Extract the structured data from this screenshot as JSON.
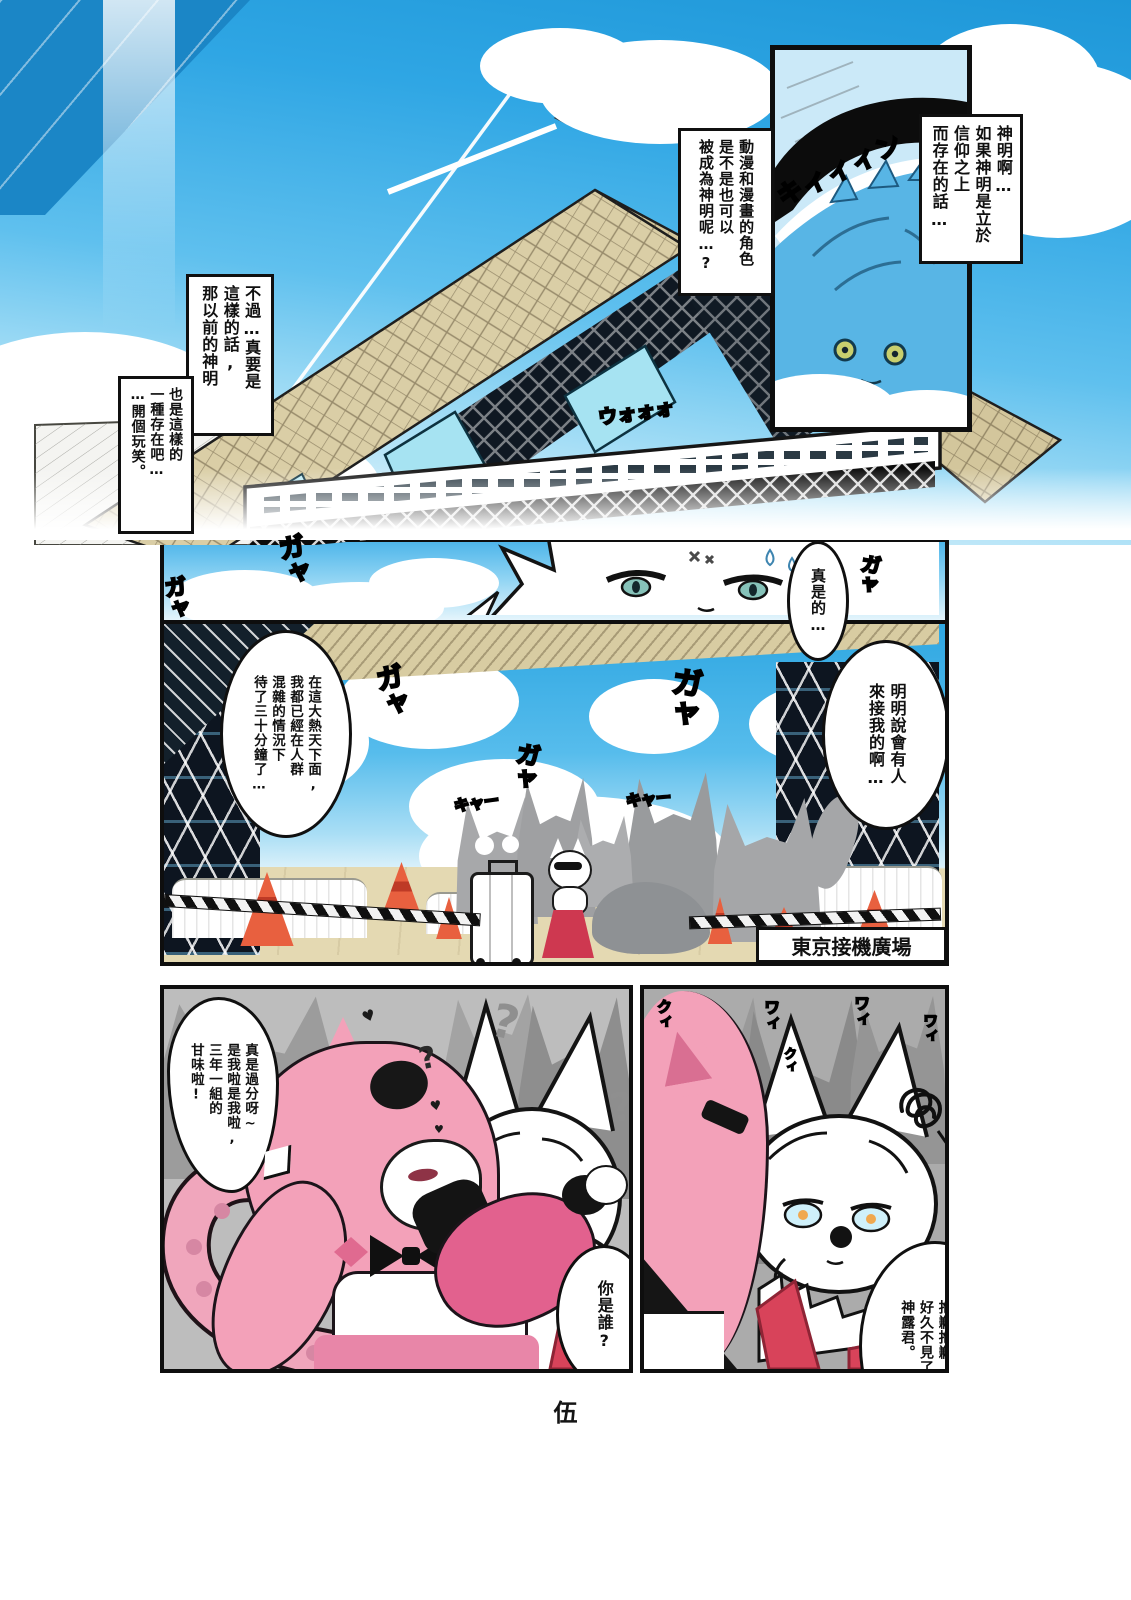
{
  "page_number": "伍",
  "speech": {
    "god_intro": [
      "神明啊…",
      "如果神明是立於",
      "信仰之上",
      "而存在的話…"
    ],
    "anime_chars": [
      "動漫和漫畫的角色",
      "是不是也可以",
      "被成為神明呢…?"
    ],
    "however": [
      "不過…真要是",
      "這樣的話,",
      "那以前的神明"
    ],
    "joking": [
      "也是這樣的",
      "一種存在吧…",
      "…開個玩笑。"
    ],
    "geez": [
      "真是的…"
    ],
    "pickup": [
      "明明說會有人",
      "來接我的啊…"
    ],
    "waiting": [
      "在這大熱天下面,",
      "我都已經在人群",
      "混雜的情況下",
      "待了三十分鐘了…"
    ],
    "outrage": [
      "真是過分呀~",
      "是我啦是我啦,",
      "三年一組的",
      "甘味啦!"
    ],
    "who": [
      "你是誰?"
    ],
    "apology": [
      "讓你久等了,",
      "抱歉抱歉,",
      "好久不見了,",
      "神露君。"
    ]
  },
  "labels": {
    "plaza_sign": "東京接機廣場"
  },
  "sfx": {
    "train_whine": "キィィィン",
    "crowd_roar": "ウォォォ",
    "gaya": "ガャ",
    "kyaa": "キャー",
    "wai": "ワィ",
    "kui": "クィ"
  },
  "marks": {
    "question": "?",
    "heart": "♥"
  },
  "palette": {
    "sky": "#2EA4E2",
    "building_tan": "#D8CCA2",
    "glass_cyan": "#A6E3F2",
    "crowd_grey": "#A6A7A9",
    "pink_hair": "#F3A1B9",
    "deep_pink": "#E2618E",
    "hakama_red": "#D8435A",
    "cone_orange": "#E8603F"
  }
}
